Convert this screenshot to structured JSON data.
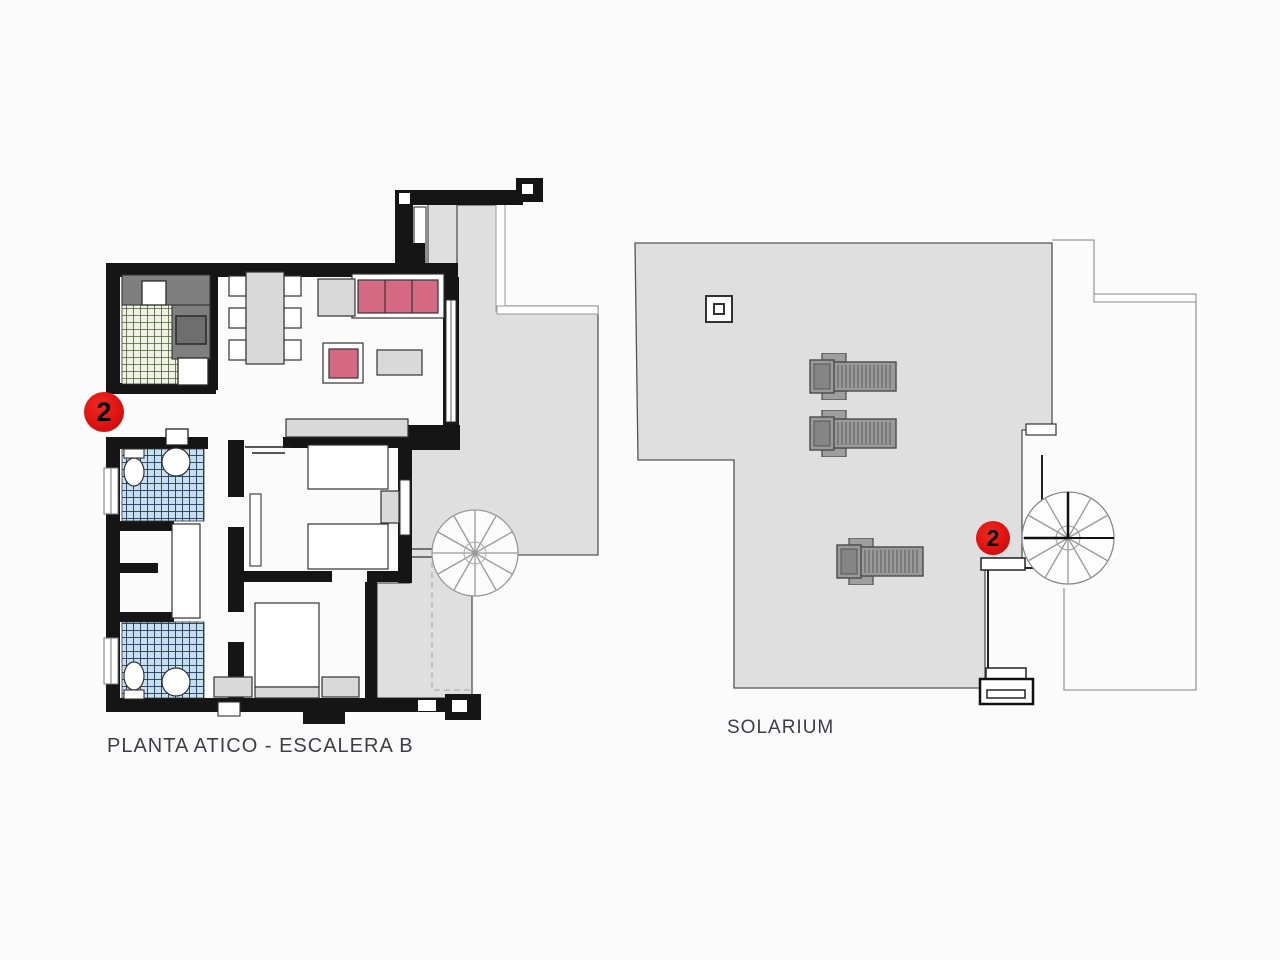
{
  "canvas": {
    "width": 1280,
    "height": 960,
    "background": "#fbfbfb"
  },
  "colors": {
    "wall": "#151515",
    "terrace": "#dfdfdf",
    "pink": "#d66a85",
    "badge": "#de1212",
    "label": "#3d3d48",
    "counter": "#7f7f7f",
    "furn": "#d9d9d9",
    "lounger": "#999999"
  },
  "left_plan": {
    "label": "PLANTA ATICO - ESCALERA B",
    "unit_badge": "2",
    "rooms": [
      "kitchen",
      "living-dining",
      "bathroom-1",
      "bathroom-2",
      "bedroom-1",
      "bedroom-2",
      "terrace",
      "spiral-staircase"
    ]
  },
  "right_plan": {
    "label": "SOLARIUM",
    "unit_badge": "2",
    "features": [
      "sun-loungers",
      "spiral-staircase",
      "skylight"
    ]
  },
  "solarium_loungers": [
    {
      "x": 808,
      "y": 353
    },
    {
      "x": 808,
      "y": 410
    },
    {
      "x": 835,
      "y": 538
    }
  ]
}
